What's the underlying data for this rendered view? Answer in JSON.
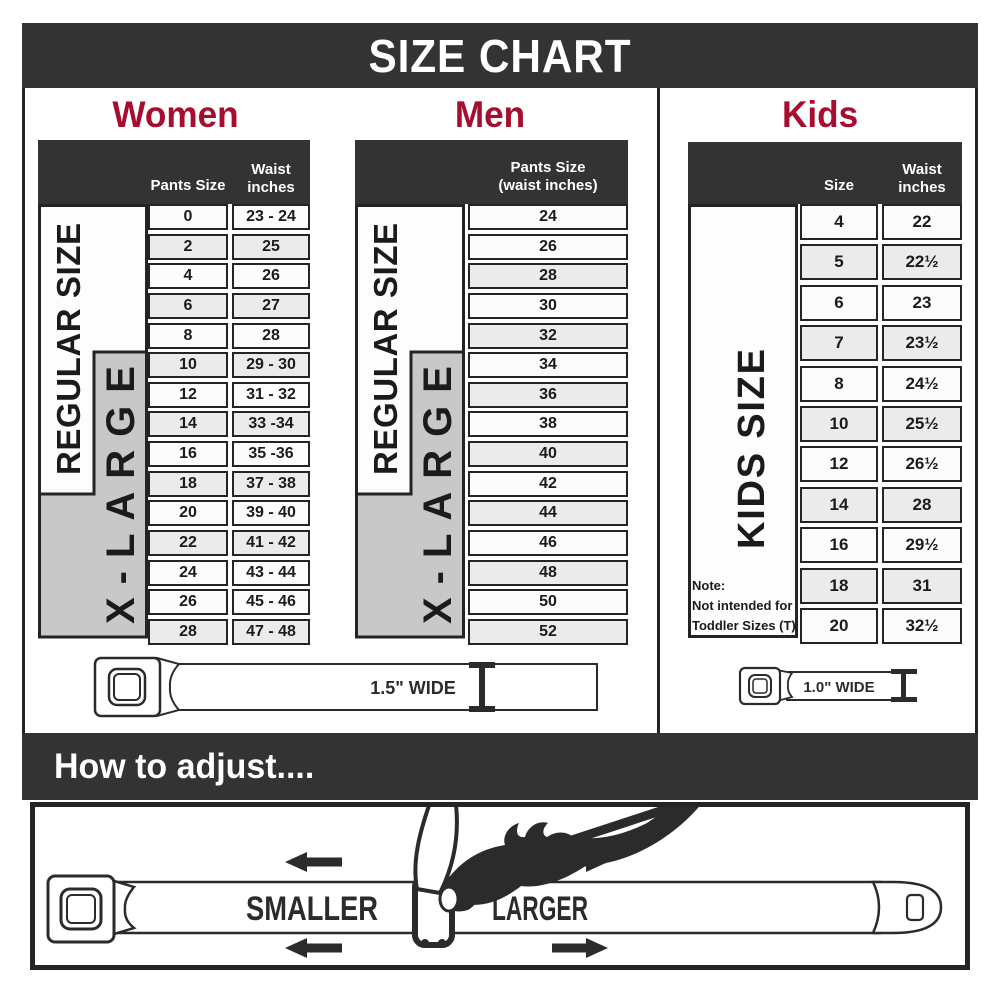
{
  "title": "SIZE CHART",
  "sections": {
    "women": {
      "title": "Women",
      "col1_header": "Pants Size",
      "col2_header_line1": "Waist",
      "col2_header_line2": "inches",
      "regular_label": "REGULAR SIZE",
      "xlarge_label": "X-LARGE",
      "rows": [
        {
          "size": "0",
          "waist": "23 - 24",
          "shaded": false
        },
        {
          "size": "2",
          "waist": "25",
          "shaded": true
        },
        {
          "size": "4",
          "waist": "26",
          "shaded": false
        },
        {
          "size": "6",
          "waist": "27",
          "shaded": true
        },
        {
          "size": "8",
          "waist": "28",
          "shaded": false
        },
        {
          "size": "10",
          "waist": "29 - 30",
          "shaded": true
        },
        {
          "size": "12",
          "waist": "31 - 32",
          "shaded": false
        },
        {
          "size": "14",
          "waist": "33 -34",
          "shaded": true
        },
        {
          "size": "16",
          "waist": "35 -36",
          "shaded": false
        },
        {
          "size": "18",
          "waist": "37 - 38",
          "shaded": true
        },
        {
          "size": "20",
          "waist": "39 - 40",
          "shaded": false
        },
        {
          "size": "22",
          "waist": "41 - 42",
          "shaded": true
        },
        {
          "size": "24",
          "waist": "43 - 44",
          "shaded": false
        },
        {
          "size": "26",
          "waist": "45 - 46",
          "shaded": false
        },
        {
          "size": "28",
          "waist": "47 - 48",
          "shaded": true
        }
      ],
      "belt_width_label": "1.5\" WIDE"
    },
    "men": {
      "title": "Men",
      "col_header_line1": "Pants Size",
      "col_header_line2": "(waist inches)",
      "regular_label": "REGULAR SIZE",
      "xlarge_label": "X-LARGE",
      "rows": [
        {
          "value": "24",
          "shaded": false
        },
        {
          "value": "26",
          "shaded": false
        },
        {
          "value": "28",
          "shaded": true
        },
        {
          "value": "30",
          "shaded": false
        },
        {
          "value": "32",
          "shaded": true
        },
        {
          "value": "34",
          "shaded": false
        },
        {
          "value": "36",
          "shaded": true
        },
        {
          "value": "38",
          "shaded": false
        },
        {
          "value": "40",
          "shaded": true
        },
        {
          "value": "42",
          "shaded": false
        },
        {
          "value": "44",
          "shaded": true
        },
        {
          "value": "46",
          "shaded": false
        },
        {
          "value": "48",
          "shaded": true
        },
        {
          "value": "50",
          "shaded": false
        },
        {
          "value": "52",
          "shaded": true
        }
      ]
    },
    "kids": {
      "title": "Kids",
      "col1_header": "Size",
      "col2_header_line1": "Waist",
      "col2_header_line2": "inches",
      "side_label": "KIDS SIZE",
      "note_line1": "Note:",
      "note_line2": "Not intended for",
      "note_line3": "Toddler Sizes (T)",
      "rows": [
        {
          "size": "4",
          "waist": "22",
          "shaded": false
        },
        {
          "size": "5",
          "waist": "22½",
          "shaded": true
        },
        {
          "size": "6",
          "waist": "23",
          "shaded": false
        },
        {
          "size": "7",
          "waist": "23½",
          "shaded": true
        },
        {
          "size": "8",
          "waist": "24½",
          "shaded": false
        },
        {
          "size": "10",
          "waist": "25½",
          "shaded": true
        },
        {
          "size": "12",
          "waist": "26½",
          "shaded": false
        },
        {
          "size": "14",
          "waist": "28",
          "shaded": true
        },
        {
          "size": "16",
          "waist": "29½",
          "shaded": false
        },
        {
          "size": "18",
          "waist": "31",
          "shaded": true
        },
        {
          "size": "20",
          "waist": "32½",
          "shaded": false
        }
      ],
      "belt_width_label": "1.0\" WIDE"
    }
  },
  "adjust": {
    "title": "How to adjust....",
    "smaller_label": "SMALLER",
    "larger_label": "LARGER"
  },
  "colors": {
    "banner_bg": "#333333",
    "accent_red": "#A60D2F",
    "shaded_row": "#EBEBEB",
    "xlarge_gray": "#C8C8C8",
    "ink": "#2B2B2B"
  },
  "chart_data": [
    {
      "type": "table",
      "title": "Women",
      "columns": [
        "Pants Size",
        "Waist inches"
      ],
      "rows": [
        [
          "0",
          "23 - 24"
        ],
        [
          "2",
          "25"
        ],
        [
          "4",
          "26"
        ],
        [
          "6",
          "27"
        ],
        [
          "8",
          "28"
        ],
        [
          "10",
          "29 - 30"
        ],
        [
          "12",
          "31 - 32"
        ],
        [
          "14",
          "33 -34"
        ],
        [
          "16",
          "35 -36"
        ],
        [
          "18",
          "37 - 38"
        ],
        [
          "20",
          "39 - 40"
        ],
        [
          "22",
          "41 - 42"
        ],
        [
          "24",
          "43 - 44"
        ],
        [
          "26",
          "45 - 46"
        ],
        [
          "28",
          "47 - 48"
        ]
      ],
      "groups": {
        "REGULAR SIZE": "pants sizes 0-18",
        "X-LARGE": "pants sizes 10-28"
      },
      "belt_width": "1.5\" WIDE"
    },
    {
      "type": "table",
      "title": "Men",
      "columns": [
        "Pants Size (waist inches)"
      ],
      "rows": [
        [
          "24"
        ],
        [
          "26"
        ],
        [
          "28"
        ],
        [
          "30"
        ],
        [
          "32"
        ],
        [
          "34"
        ],
        [
          "36"
        ],
        [
          "38"
        ],
        [
          "40"
        ],
        [
          "42"
        ],
        [
          "44"
        ],
        [
          "46"
        ],
        [
          "48"
        ],
        [
          "50"
        ],
        [
          "52"
        ]
      ],
      "groups": {
        "REGULAR SIZE": "sizes 24-42",
        "X-LARGE": "sizes 34-52"
      },
      "belt_width": "1.5\" WIDE"
    },
    {
      "type": "table",
      "title": "Kids",
      "columns": [
        "Size",
        "Waist inches"
      ],
      "rows": [
        [
          "4",
          "22"
        ],
        [
          "5",
          "22½"
        ],
        [
          "6",
          "23"
        ],
        [
          "7",
          "23½"
        ],
        [
          "8",
          "24½"
        ],
        [
          "10",
          "25½"
        ],
        [
          "12",
          "26½"
        ],
        [
          "14",
          "28"
        ],
        [
          "16",
          "29½"
        ],
        [
          "18",
          "31"
        ],
        [
          "20",
          "32½"
        ]
      ],
      "groups": {
        "KIDS SIZE": "sizes 4-20"
      },
      "note": "Not intended for Toddler Sizes (T)",
      "belt_width": "1.0\" WIDE"
    }
  ]
}
